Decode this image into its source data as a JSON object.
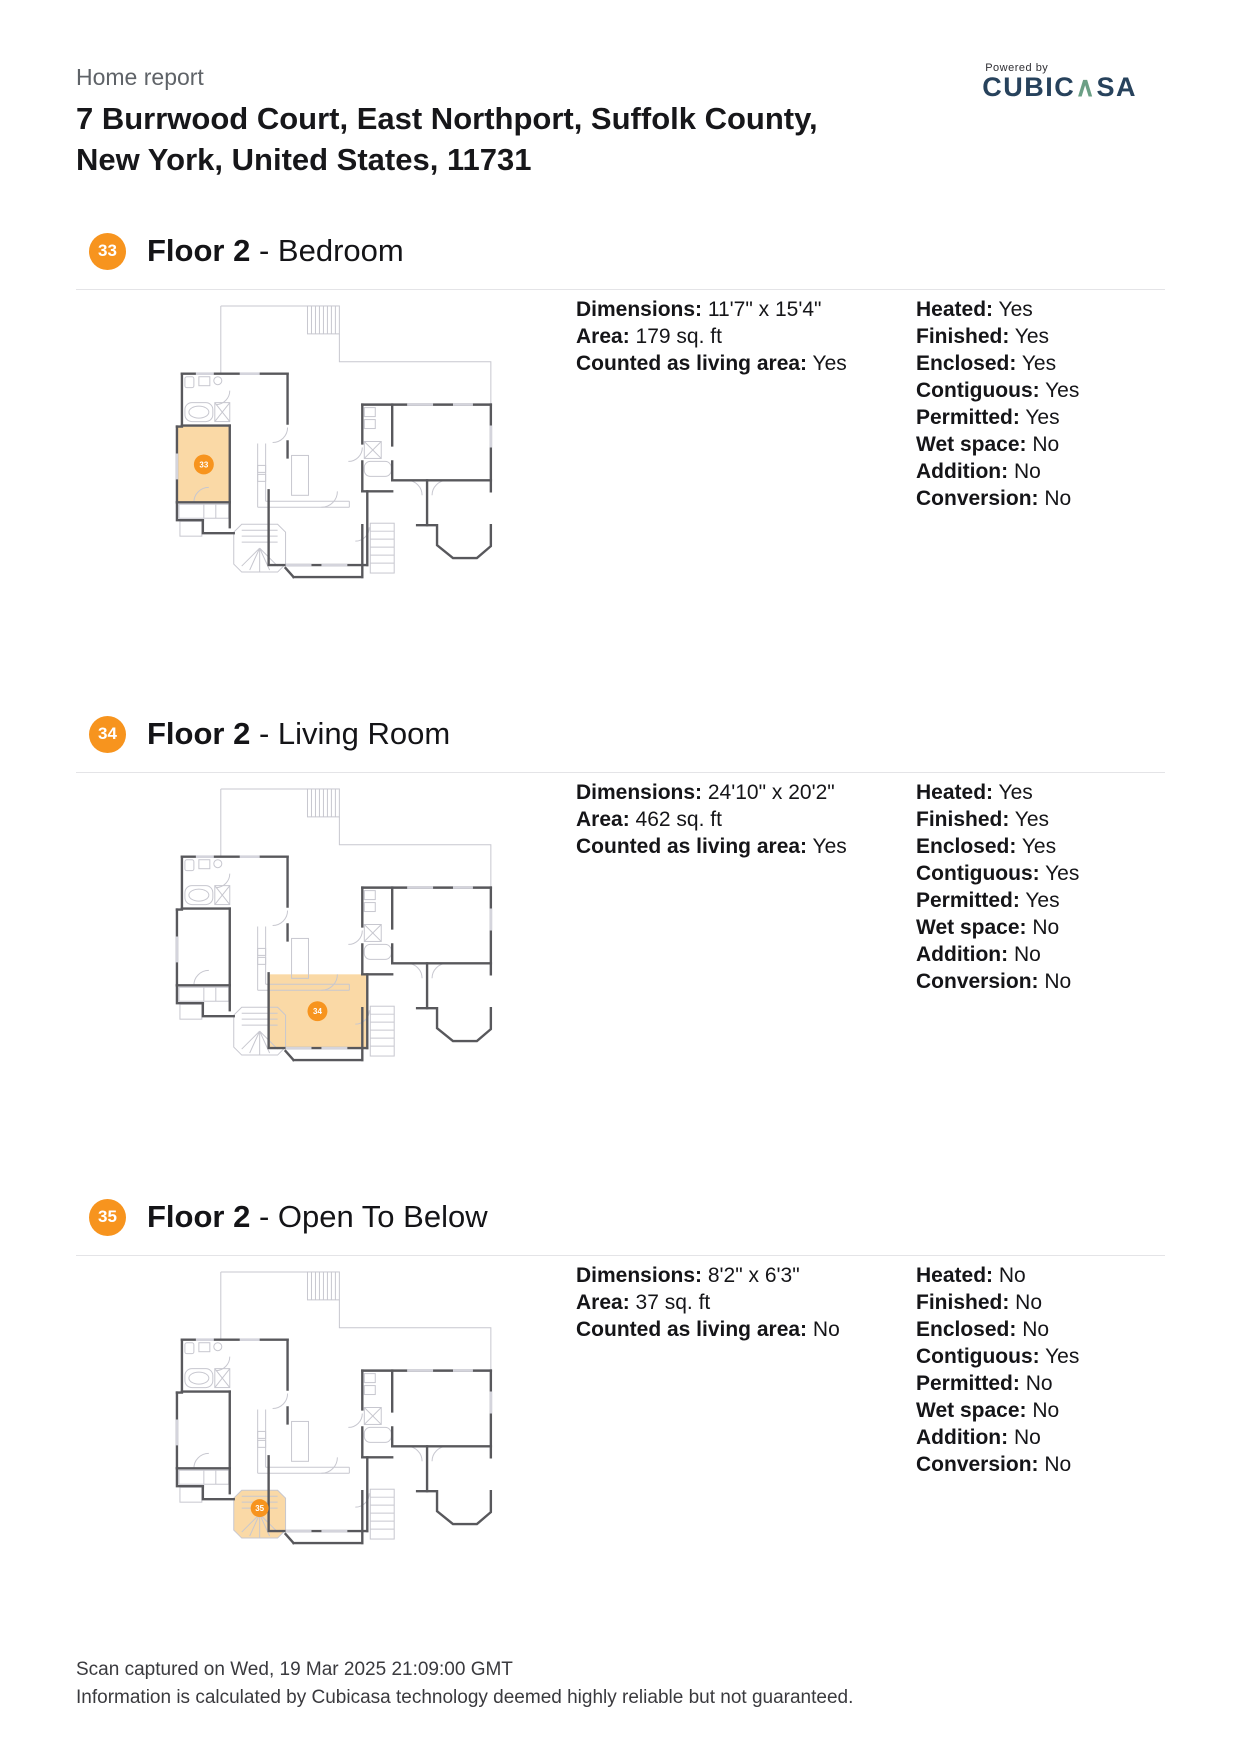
{
  "header": {
    "report_label": "Home report",
    "address_line1": "7 Burrwood Court, East Northport, Suffolk County,",
    "address_line2": "New York, United States, 11731",
    "logo": {
      "powered_by": "Powered by",
      "brand_pre": "CUBIC",
      "brand_caret": "∧",
      "brand_post": "SA"
    }
  },
  "colors": {
    "accent_orange": "#f7941e",
    "highlight_fill": "#fad9a6",
    "brand_navy": "#27425c",
    "brand_teal": "#6b9f85"
  },
  "sections": [
    {
      "badge": "33",
      "floor_label": "Floor 2",
      "separator": " - ",
      "room_name": "Bedroom",
      "details": [
        {
          "label": "Dimensions:",
          "value": "11'7\" x 15'4\""
        },
        {
          "label": "Area:",
          "value": "179 sq. ft"
        },
        {
          "label": "Counted as living area:",
          "value": "Yes"
        }
      ],
      "attributes": [
        {
          "label": "Heated:",
          "value": "Yes"
        },
        {
          "label": "Finished:",
          "value": "Yes"
        },
        {
          "label": "Enclosed:",
          "value": "Yes"
        },
        {
          "label": "Contiguous:",
          "value": "Yes"
        },
        {
          "label": "Permitted:",
          "value": "Yes"
        },
        {
          "label": "Wet space:",
          "value": "No"
        },
        {
          "label": "Addition:",
          "value": "No"
        },
        {
          "label": "Conversion:",
          "value": "No"
        }
      ],
      "highlight": {
        "shape": "rect",
        "x": 69,
        "y": 131,
        "w": 53,
        "h": 76,
        "bx": 96,
        "by": 169,
        "br": 10
      }
    },
    {
      "badge": "34",
      "floor_label": "Floor 2",
      "separator": " - ",
      "room_name": "Living Room",
      "details": [
        {
          "label": "Dimensions:",
          "value": "24'10\" x 20'2\""
        },
        {
          "label": "Area:",
          "value": "462 sq. ft"
        },
        {
          "label": "Counted as living area:",
          "value": "Yes"
        }
      ],
      "attributes": [
        {
          "label": "Heated:",
          "value": "Yes"
        },
        {
          "label": "Finished:",
          "value": "Yes"
        },
        {
          "label": "Enclosed:",
          "value": "Yes"
        },
        {
          "label": "Contiguous:",
          "value": "Yes"
        },
        {
          "label": "Permitted:",
          "value": "Yes"
        },
        {
          "label": "Wet space:",
          "value": "No"
        },
        {
          "label": "Addition:",
          "value": "No"
        },
        {
          "label": "Conversion:",
          "value": "No"
        }
      ],
      "highlight": {
        "shape": "rect",
        "x": 161,
        "y": 196,
        "w": 99,
        "h": 73,
        "bx": 210,
        "by": 233,
        "br": 10
      }
    },
    {
      "badge": "35",
      "floor_label": "Floor 2",
      "separator": " - ",
      "room_name": "Open To Below",
      "details": [
        {
          "label": "Dimensions:",
          "value": "8'2\" x 6'3\""
        },
        {
          "label": "Area:",
          "value": "37 sq. ft"
        },
        {
          "label": "Counted as living area:",
          "value": "No"
        }
      ],
      "attributes": [
        {
          "label": "Heated:",
          "value": "No"
        },
        {
          "label": "Finished:",
          "value": "No"
        },
        {
          "label": "Enclosed:",
          "value": "No"
        },
        {
          "label": "Contiguous:",
          "value": "Yes"
        },
        {
          "label": "Permitted:",
          "value": "No"
        },
        {
          "label": "Wet space:",
          "value": "No"
        },
        {
          "label": "Addition:",
          "value": "No"
        },
        {
          "label": "Conversion:",
          "value": "No"
        }
      ],
      "highlight": {
        "shape": "octagon",
        "cx": 152,
        "cy": 253,
        "bx": 152,
        "by": 247,
        "br": 9
      }
    }
  ],
  "footer": {
    "line1": "Scan captured on Wed, 19 Mar 2025 21:09:00 GMT",
    "line2": "Information is calculated by Cubicasa technology deemed highly reliable but not guaranteed."
  }
}
